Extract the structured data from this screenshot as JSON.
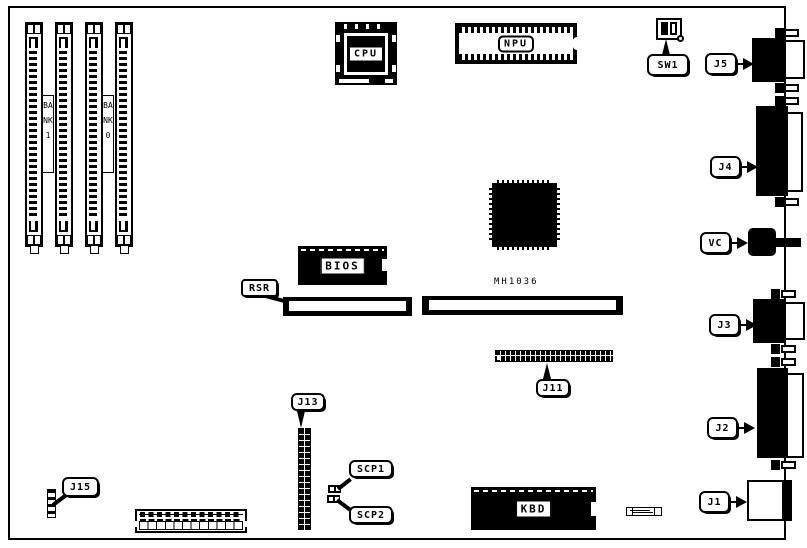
{
  "diagram": {
    "banks": {
      "bank1": "BANK1",
      "bank0": "BANK0"
    },
    "chips": {
      "cpu": "CPU",
      "npu": "NPU",
      "bios": "BIOS",
      "kbd": "KBD"
    },
    "ic_label": "MH1036",
    "callouts": {
      "sw1": "SW1",
      "j5": "J5",
      "j4": "J4",
      "vc": "VC",
      "j3": "J3",
      "j2": "J2",
      "j1": "J1",
      "rsr": "RSR",
      "j11": "J11",
      "j13": "J13",
      "scp1": "SCP1",
      "scp2": "SCP2",
      "j15": "J15"
    },
    "colors": {
      "ink": "#000000",
      "paper": "#ffffff"
    }
  }
}
